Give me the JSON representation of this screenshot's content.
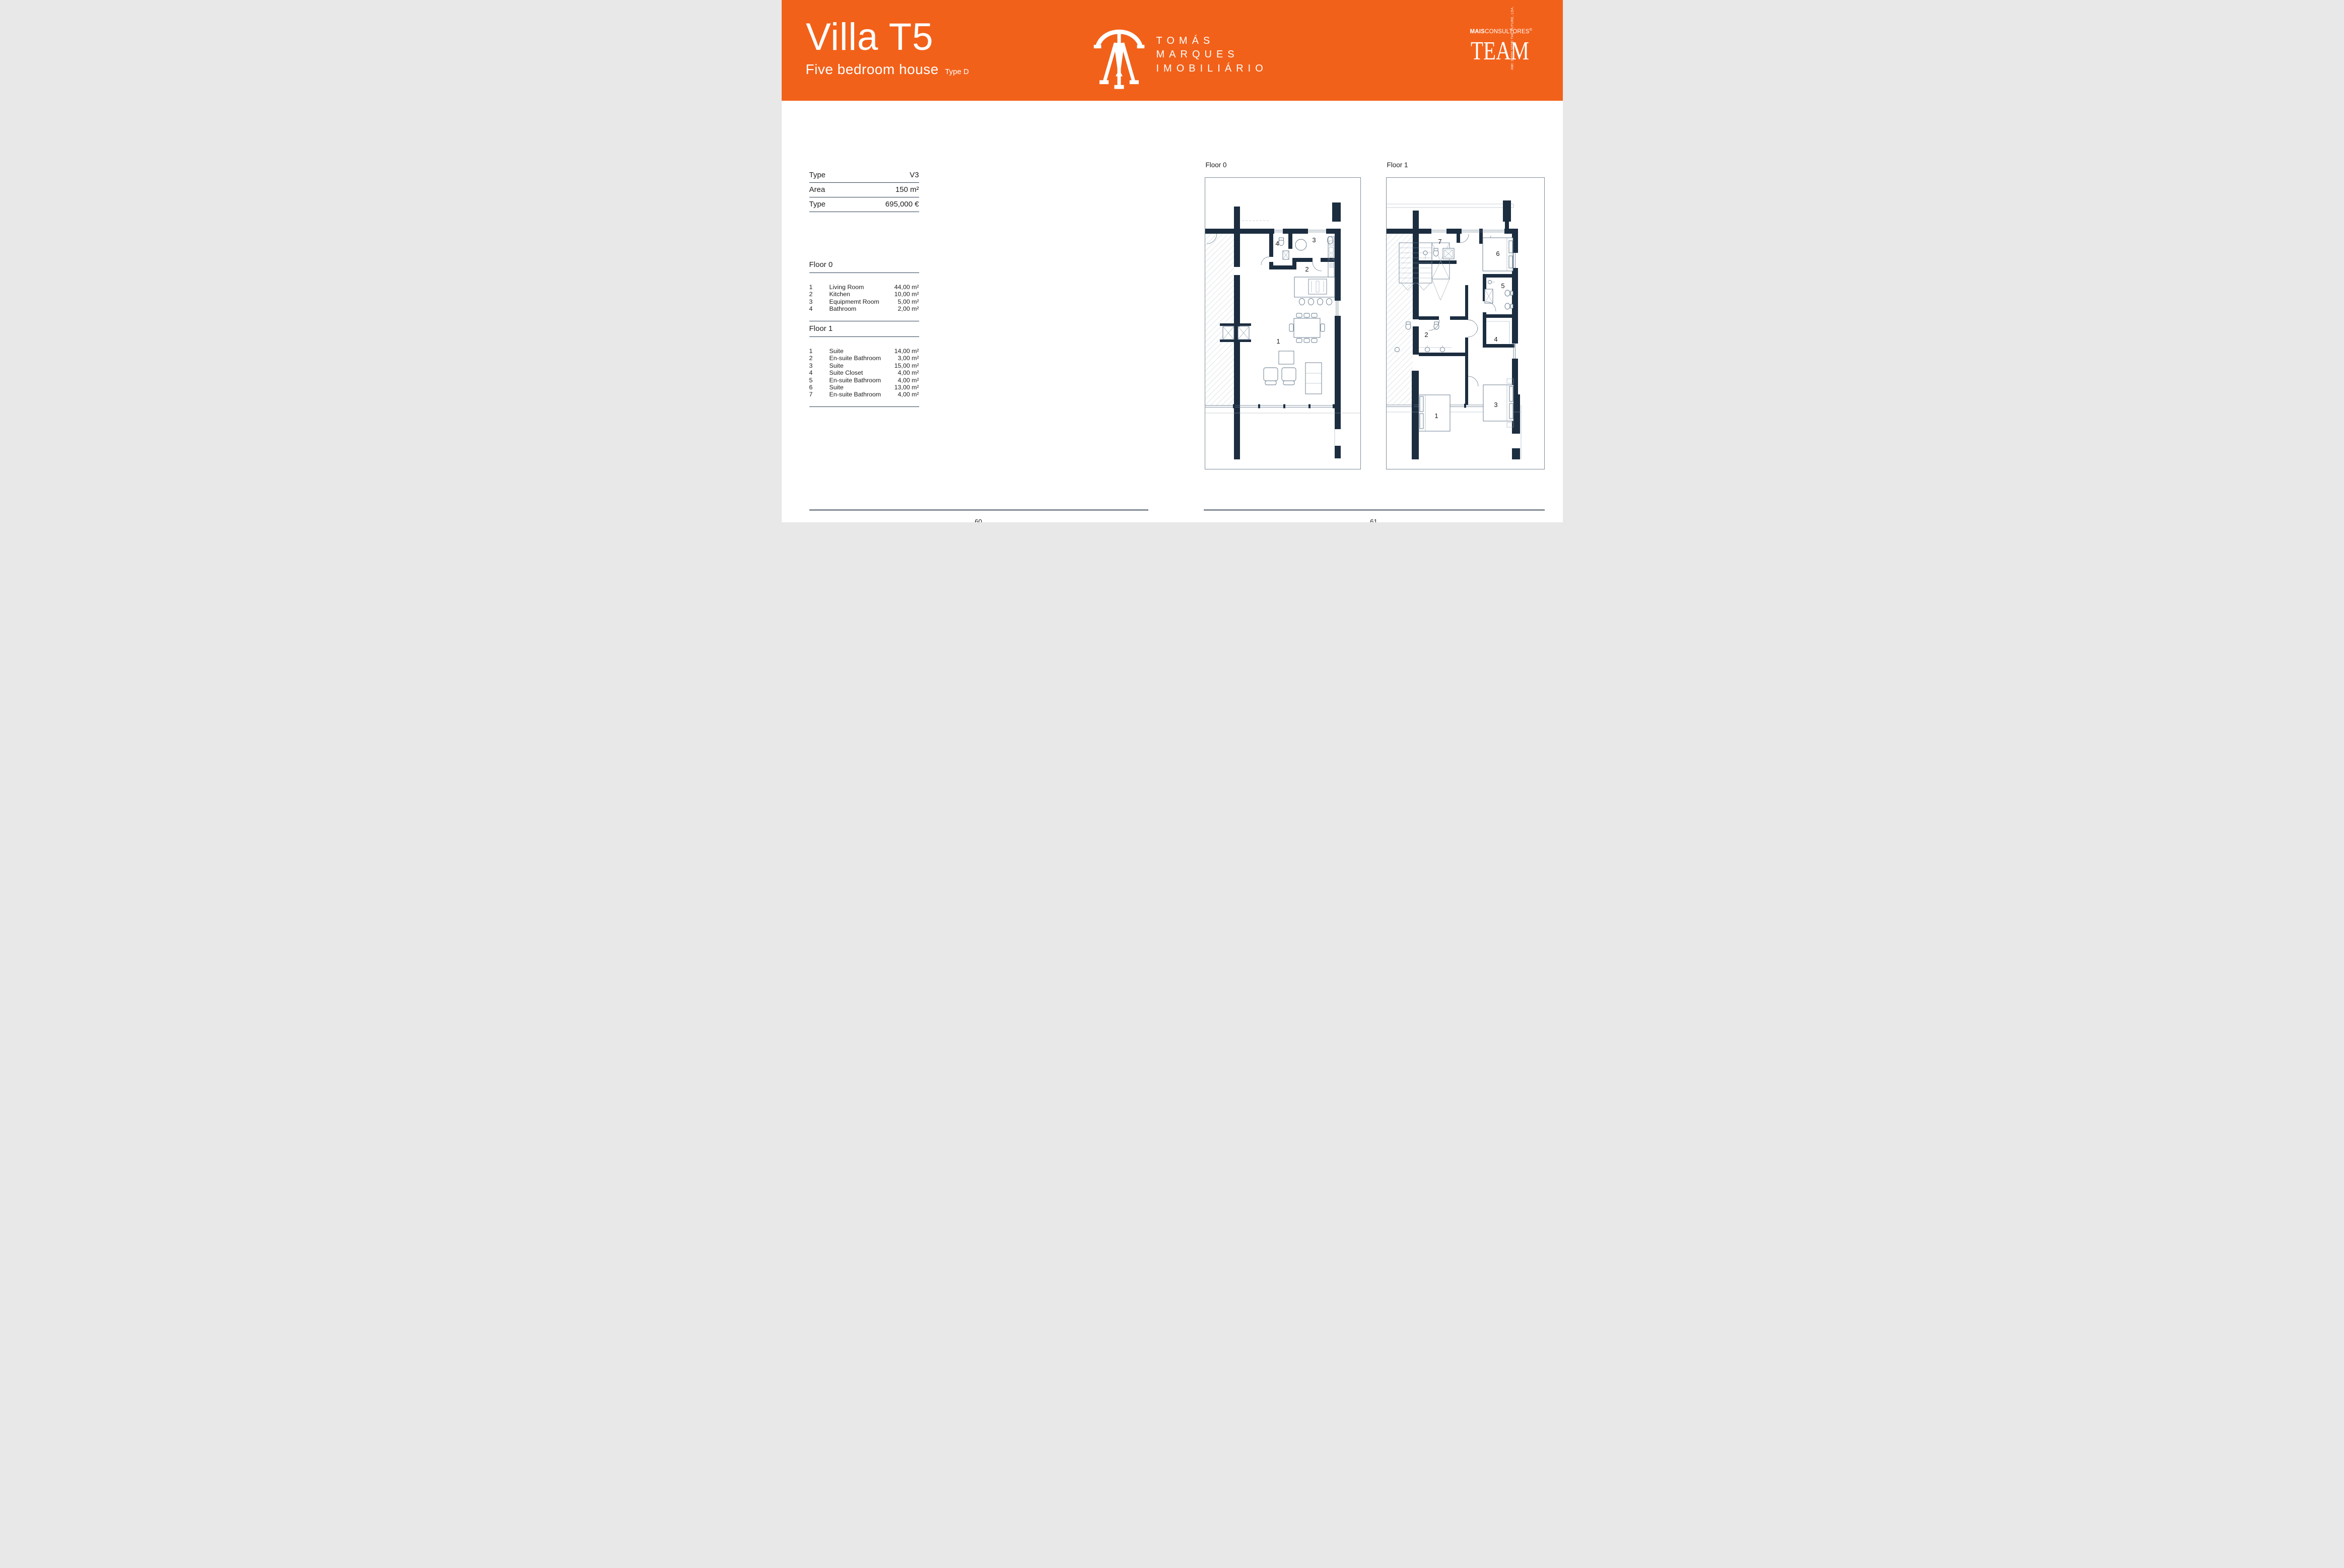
{
  "header": {
    "title": "Villa T5",
    "subtitle": "Five bedroom house",
    "type_label": "Type D",
    "brand": {
      "line1": "TOMÁS",
      "line2": "MARQUES",
      "line3": "IMOBILIÁRIO"
    },
    "team": {
      "mais": "MAIS",
      "consultores": "CONSULTORES",
      "reg": "®",
      "word": "TEAM",
      "side": "AMI: 23990  SEED THE FUTURE, LDA."
    }
  },
  "specs": {
    "rows": [
      {
        "label": "Type",
        "value": "V3"
      },
      {
        "label": "Area",
        "value": "150 m²"
      },
      {
        "label": "Type",
        "value": "695,000 €"
      }
    ]
  },
  "floor0": {
    "title": "Floor 0",
    "rooms": [
      {
        "num": "1",
        "name": "Living Room",
        "area": "44,00 m²"
      },
      {
        "num": "2",
        "name": "Kitchen",
        "area": "10,00 m²"
      },
      {
        "num": "3",
        "name": "Equipmemt Room",
        "area": "5,00 m²"
      },
      {
        "num": "4",
        "name": "Bathroom",
        "area": "2,00 m²"
      }
    ]
  },
  "floor1": {
    "title": "Floor 1",
    "rooms": [
      {
        "num": "1",
        "name": "Suite",
        "area": "14,00 m²"
      },
      {
        "num": "2",
        "name": "En-suite Bathroom",
        "area": "3,00 m²"
      },
      {
        "num": "3",
        "name": "Suite",
        "area": "15,00 m²"
      },
      {
        "num": "4",
        "name": "Suite Closet",
        "area": "4,00 m²"
      },
      {
        "num": "5",
        "name": "En-suite Bathroom",
        "area": "4,00 m²"
      },
      {
        "num": "6",
        "name": "Suite",
        "area": "13,00 m²"
      },
      {
        "num": "7",
        "name": "En-suite Bathroom",
        "area": "4,00 m²"
      }
    ]
  },
  "plans": {
    "floor0_label": "Floor 0",
    "floor1_label": "Floor 1",
    "floor0_numbers": [
      "1",
      "2",
      "3",
      "4"
    ],
    "floor1_numbers": [
      "1",
      "2",
      "3",
      "4",
      "5",
      "6",
      "7"
    ]
  },
  "footer": {
    "left_page": "60",
    "right_page": "61"
  },
  "colors": {
    "orange": "#F2611A",
    "navy": "#1C2D40",
    "rule": "#2E4156",
    "footer_line": "#848D95"
  }
}
